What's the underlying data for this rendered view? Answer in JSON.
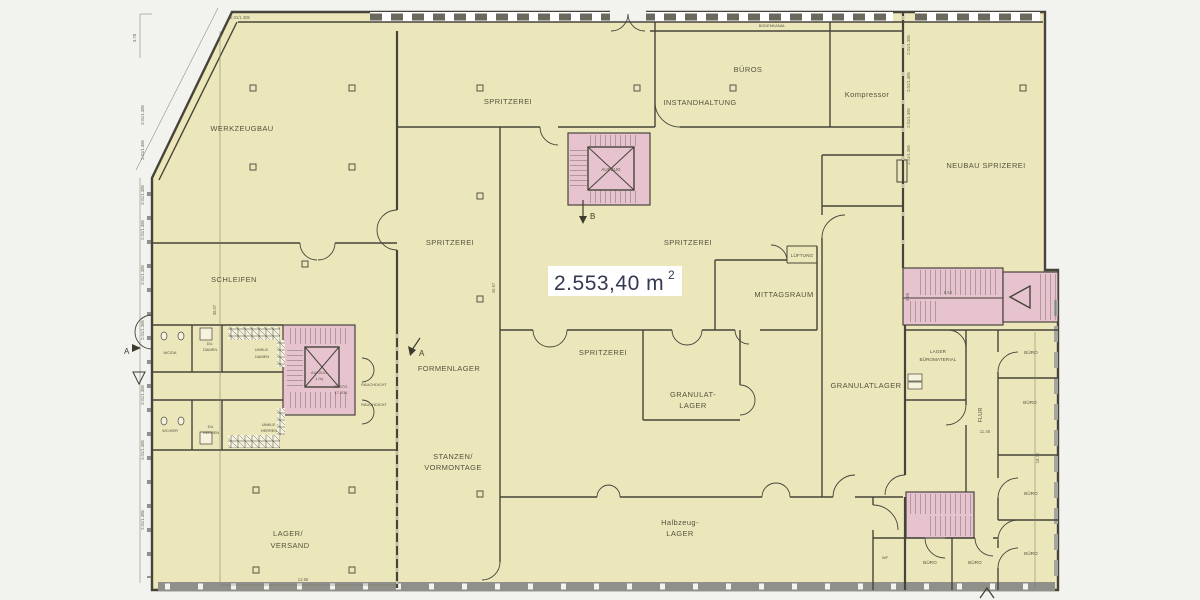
{
  "colors": {
    "background": "#f2f2ef",
    "room_fill": "#ece7bb",
    "stair_fill": "#e7c3cf",
    "wall": "#46443a",
    "label_text": "#55523e",
    "area_text": "#333850",
    "window_band": "#90908a"
  },
  "area": {
    "value": "2.553,40 m",
    "sup": "2"
  },
  "rooms": {
    "werkzeugbau": "WERKZEUGBAU",
    "spritzerei": "SPRITZEREI",
    "bueros": "BÜROS",
    "instandhaltung": "INSTANDHALTUNG",
    "kompressor": "Kompressor",
    "neubau": "NEUBAU SPRIZEREI",
    "schleifen": "SCHLEIFEN",
    "mittagsraum": "MITTAGSRAUM",
    "lueftung": "LÜFTUNG",
    "formenlager": "FORMENLAGER",
    "granulat1": "GRANULAT-",
    "granulat2": "LAGER",
    "granulatlager": "GRANULATLAGER",
    "stanzen1": "STANZEN/",
    "stanzen2": "VORMONTAGE",
    "lagerversand1": "LAGER/",
    "lagerversand2": "VERSAND",
    "halbzeug1": "Halbzeug-",
    "halbzeug2": "LAGER",
    "lagerbuero1": "LAGER",
    "lagerbuero2": "BÜROMATERIAL",
    "flur": "FLUR",
    "buero": "BÜRO",
    "wf": "WF",
    "wc_da": "WC/DA",
    "wc_her": "WC/HER",
    "du": "DU.",
    "damen": "DAMEN",
    "herren": "HERREN",
    "umkle": "UMKLE.",
    "rauchdicht": "RAUCHDICHT",
    "aufzug": "AUFZUG",
    "aufzug_small": "AUFZUG",
    "aufzug_size": "1.0q",
    "stg1": "22 STG.",
    "stg2": "17.2/31",
    "bodenkanal": "BODENKANAL"
  },
  "dims": {
    "window": "2.01/1.385",
    "d378": "3.78",
    "d3807": "38.07",
    "d4667": "46.67",
    "d1255": "12.55",
    "d1146": "11.46",
    "d854": "8.54",
    "d389": "3.89",
    "d1830": "18.30"
  },
  "markers": {
    "a": "A",
    "b": "B"
  }
}
